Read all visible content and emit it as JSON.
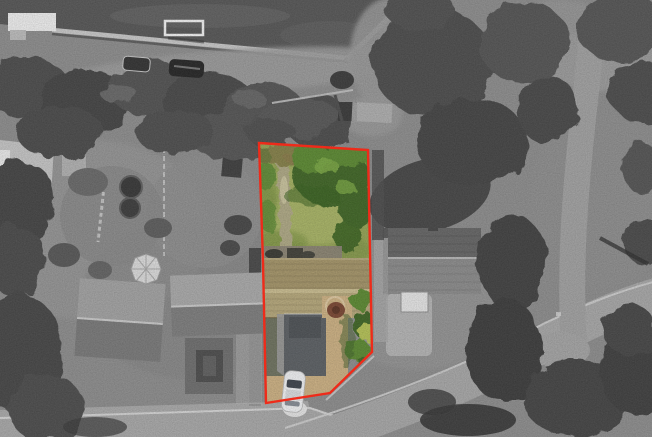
{
  "scene": {
    "kind": "aerial-property-photograph-with-highlighted-plot"
  },
  "boundary": {
    "points": "259,143 368,150 372,352 330,393 266,403 263,262",
    "color": "#ee2b1a",
    "stroke_width": 2.4
  },
  "palette": {
    "ground": "#8e8e8e",
    "field": "#575757",
    "wall": "#c9c9c9",
    "goal": "#f3f3f3",
    "building": "#efefef",
    "gravel": "#9c9c9c",
    "tree_dark": "#404040",
    "tree": "#4c4c4c",
    "tree_light": "#5f5f5f",
    "hedge": "#434343",
    "shadow": "#303030",
    "road": "#a9a9a9",
    "road_lane": "#a2a2a2",
    "curb": "#d6d6d6",
    "pavement": "#b6b6b6",
    "car_gray": "#333333",
    "roof_pale": "#c6c6c6",
    "roof_light": "#a3a3a3",
    "roof_dark": "#7a7a7a",
    "ridge": "#cdcdcd",
    "courtyard": "#6f6f6f",
    "greenhouse": "#dcdcdc",
    "right_roof_dark": "#666666",
    "right_roof_mid": "#8c8c8c",
    "dormer": "#e6e6e6",
    "lawn": "#95a455",
    "lawn_light": "#abb767",
    "lawn_dark": "#78923f",
    "garden_tree_dark": "#3f6625",
    "garden_tree": "#5c8a33",
    "garden_tree_light": "#7aa744",
    "shrub_olive": "#868148",
    "lawn_path": "#afa985",
    "patio": "#8a8374",
    "furniture": "#3a3a33",
    "roof_tan_upper": "#a59569",
    "roof_tan_lower": "#b6a87b",
    "roof_tan_ridge": "#cabd90",
    "tile_line": "#7c6e4e",
    "garage": "#5c6064",
    "garage_trim": "#9b9b9b",
    "driveway": "#cdb183",
    "driveway_light": "#e0cba4",
    "bush_red": "#7b4733",
    "bush_yellow": "#b5c257",
    "car_white": "#f1f2f4",
    "windshield": "#3e444d"
  }
}
